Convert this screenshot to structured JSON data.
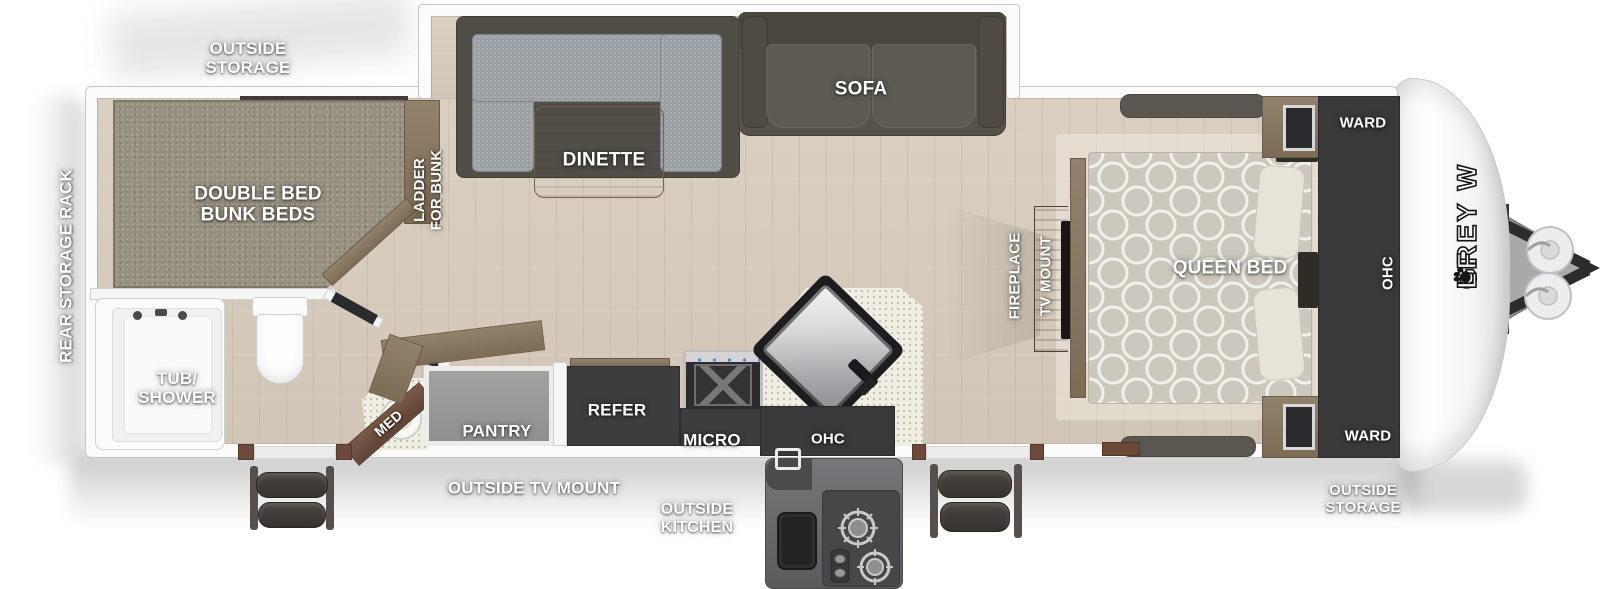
{
  "title": "Grey Wolf travel trailer floor plan",
  "brand": {
    "part1": "GREY W",
    "part2": "LF"
  },
  "palette": {
    "background": "#ffffff",
    "wall": "#f6f6f6",
    "wall_edge": "#c8c8c8",
    "floor_wood": "#d6ccbe",
    "cabinet_dark": "#3d3d3f",
    "wood_trim": "#8a7a64",
    "counter_speckle": "#f0ede2",
    "dinette_fabric": "#9aa0a4",
    "sofa_dark": "#55524a",
    "mattress_gray": "#96907f",
    "label_text": "#ffffff"
  },
  "labels": {
    "exterior": {
      "outside_storage_front": "OUTSIDE\nSTORAGE",
      "rear_storage_rack": "REAR STORAGE RACK",
      "outside_tv_mount": "OUTSIDE TV MOUNT",
      "outside_kitchen": "OUTSIDE\nKITCHEN",
      "outside_storage_rear": "OUTSIDE\nSTORAGE"
    },
    "rooms": {
      "bunk_beds": "DOUBLE BED\nBUNK BEDS",
      "ladder": "LADDER\nFOR BUNK",
      "dinette": "DINETTE",
      "sofa": "SOFA",
      "tub_shower": "TUB/\nSHOWER",
      "med": "MED",
      "pantry": "PANTRY",
      "refer": "REFER",
      "micro": "MICRO",
      "ohc_kitchen": "OHC",
      "fireplace": "FIREPLACE",
      "tv_mount": "TV MOUNT",
      "queen_bed": "QUEEN BED",
      "ward_top": "WARD",
      "ohc_bedroom": "OHC",
      "ward_bottom": "WARD"
    }
  }
}
